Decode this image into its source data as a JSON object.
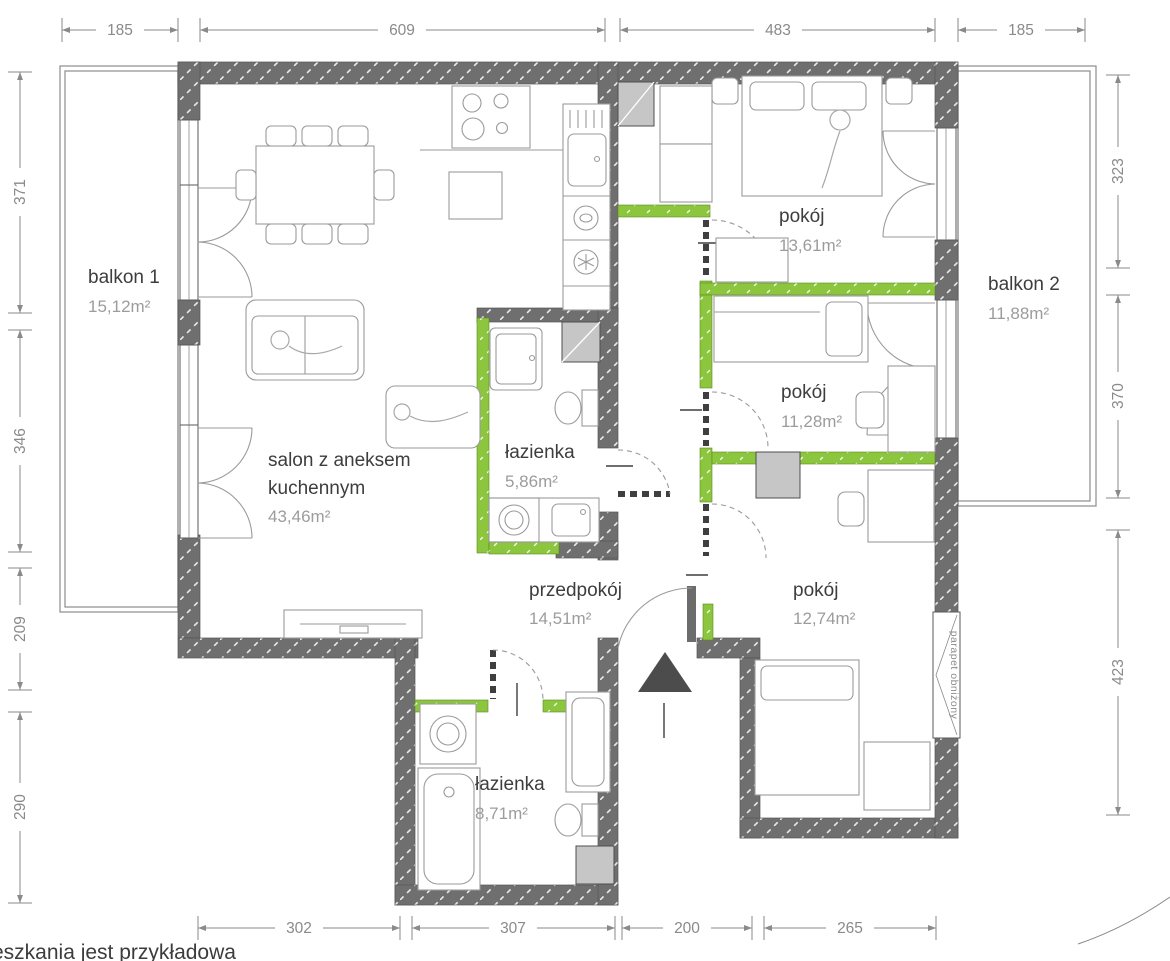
{
  "document": {
    "type": "apartment-floor-plan"
  },
  "colors": {
    "wall": "#6f6f6f",
    "accent_green": "#8cc63e",
    "dimension": "#8a8a8a",
    "room_name": "#3d3d3d",
    "room_area": "#9c9c9c",
    "entrance_marker": "#4c4c4c",
    "shaft": "#c6c6c6",
    "background": "#ffffff"
  },
  "rooms": [
    {
      "name": "balkon 1",
      "area": "15,12m²"
    },
    {
      "name_line1": "salon z aneksem",
      "name_line2": "kuchennym",
      "area": "43,46m²"
    },
    {
      "name": "łazienka",
      "area": "5,86m²"
    },
    {
      "name": "pokój",
      "area": "13,61m²"
    },
    {
      "name": "balkon 2",
      "area": "11,88m²"
    },
    {
      "name": "pokój",
      "area": "11,28m²"
    },
    {
      "name": "przedpokój",
      "area": "14,51m²"
    },
    {
      "name": "pokój",
      "area": "12,74m²"
    },
    {
      "name": "łazienka",
      "area": "8,71m²"
    }
  ],
  "dimensions_cm": {
    "top": [
      "185",
      "609",
      "483",
      "185"
    ],
    "left": [
      "371",
      "346",
      "209",
      "290"
    ],
    "right": [
      "323",
      "370",
      "423"
    ],
    "bottom": [
      "302",
      "307",
      "200",
      "265"
    ]
  },
  "labels": {
    "window_note": "parapet obniżony",
    "bottom_note": "eszkania jest przykładowa"
  }
}
